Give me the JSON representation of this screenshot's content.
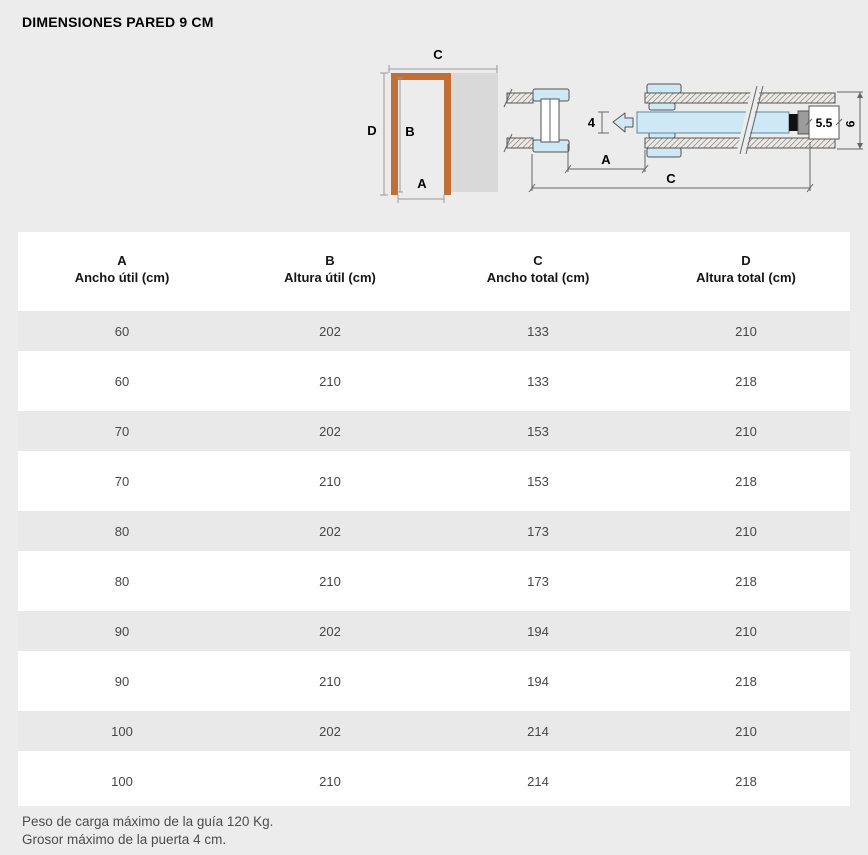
{
  "page": {
    "title": "DIMENSIONES PARED 9 CM"
  },
  "colors": {
    "background": "#ececec",
    "frame": "#c06f38",
    "pocket": "#d9d9d9",
    "door": "#cfe8f5",
    "row_stripe": "#e9e9e9"
  },
  "diagrams": {
    "front": {
      "label_a": "A",
      "label_b": "B",
      "label_c": "C",
      "label_d": "D"
    },
    "plan": {
      "label_a": "A",
      "label_c": "C",
      "door_thickness": "4",
      "rail_width": "5.5",
      "wall_thickness": "9"
    }
  },
  "table": {
    "columns": [
      {
        "letter": "A",
        "label": "Ancho útil (cm)"
      },
      {
        "letter": "B",
        "label": "Altura útil (cm)"
      },
      {
        "letter": "C",
        "label": "Ancho total (cm)"
      },
      {
        "letter": "D",
        "label": "Altura total (cm)"
      }
    ],
    "rows": [
      [
        60,
        202,
        133,
        210
      ],
      [
        60,
        210,
        133,
        218
      ],
      [
        70,
        202,
        153,
        210
      ],
      [
        70,
        210,
        153,
        218
      ],
      [
        80,
        202,
        173,
        210
      ],
      [
        80,
        210,
        173,
        218
      ],
      [
        90,
        202,
        194,
        210
      ],
      [
        90,
        210,
        194,
        218
      ],
      [
        100,
        202,
        214,
        210
      ],
      [
        100,
        210,
        214,
        218
      ]
    ]
  },
  "footer": {
    "line1": "Peso de carga máximo de la guía 120 Kg.",
    "line2": "Grosor máximo de la puerta 4 cm."
  }
}
